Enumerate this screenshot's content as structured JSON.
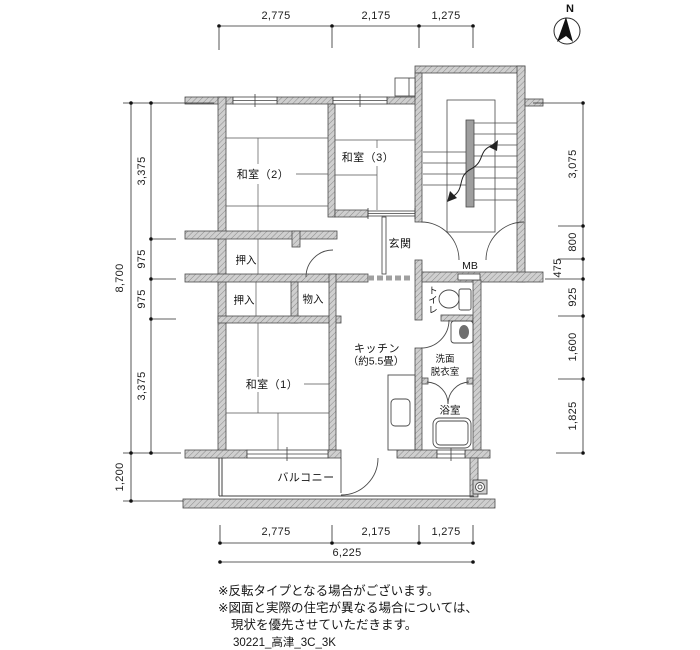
{
  "plan": {
    "plan_id": "30221_高津_3C_3K",
    "compass": {
      "north_label": "N"
    },
    "rooms": {
      "washitsu2": "和室（2）",
      "washitsu3": "和室（3）",
      "washitsu1": "和室（1）",
      "genkan": "玄関",
      "oshiire_upper": "押入",
      "oshiire_lower": "押入",
      "monoire": "物入",
      "kitchen": "キッチン",
      "kitchen_size": "（約5.5畳）",
      "toilet": "トイレ",
      "washroom_line1": "洗面",
      "washroom_line2": "脱衣室",
      "bath": "浴室",
      "meter_box": "MB",
      "balcony": "バルコニー"
    },
    "dimensions": {
      "top": [
        "2,775",
        "2,175",
        "1,275"
      ],
      "bottom": [
        "2,775",
        "2,175",
        "1,275"
      ],
      "bottom_total": "6,225",
      "left_segments": [
        "3,375",
        "975",
        "975",
        "3,375"
      ],
      "left_total": "8,700",
      "left_balcony": "1,200",
      "right_segments": [
        "3,075",
        "800",
        "475",
        "925",
        "1,600",
        "1,825"
      ]
    },
    "notes": [
      "※反転タイプとなる場合がございます。",
      "※図面と実際の住宅が異なる場合については、",
      "現状を優先させていただきます。"
    ],
    "colors": {
      "wall_fill": "#cfcfcf",
      "wall_hatch": "#8a8a8a",
      "line": "#3f3f3f",
      "text": "#141414"
    }
  }
}
